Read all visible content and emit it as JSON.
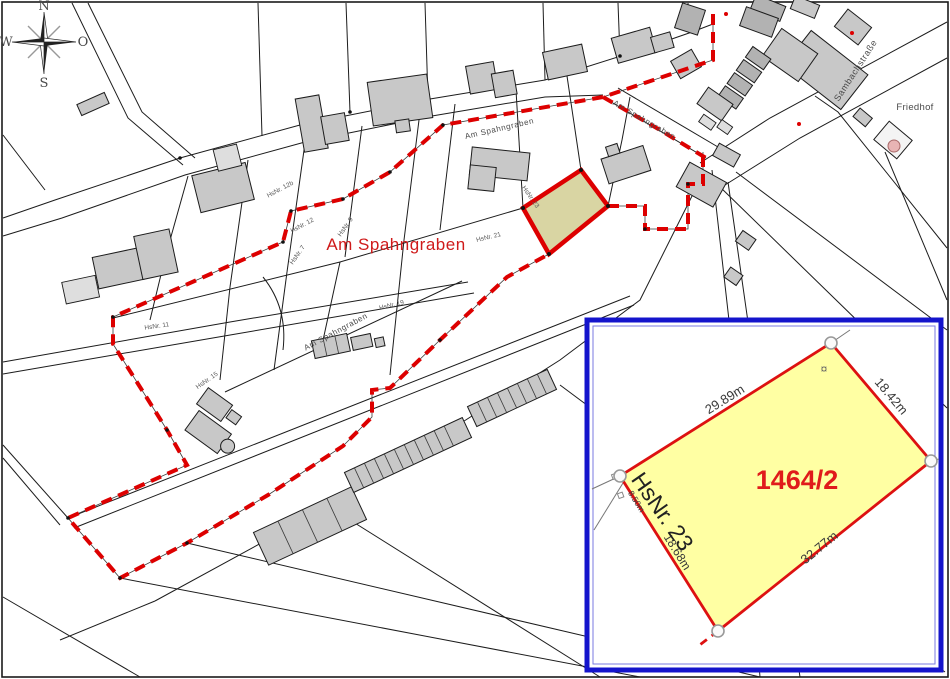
{
  "map": {
    "compass": {
      "north": "N",
      "east": "O",
      "south": "S",
      "west": "W"
    },
    "area_label_red": "Am Spahngraben",
    "street_labels": {
      "spahngraben_top": "Am Spahngraben",
      "spahngraben_branch": "Am Spahngraben",
      "spahngraben_lower": "Am Spahngraben",
      "sambachstrasse": "Sambachstraße",
      "friedhof": "Friedhof"
    },
    "house_numbers": {
      "hn_12b": "HsNr. 12b",
      "hn_12": "HsNr. 12",
      "hn_7": "HsNr. 7",
      "hn_9": "HsNr. 9",
      "hn_19": "HsNr. 19",
      "hn_21": "HsNr. 21",
      "hn_11": "HsNr. 11",
      "hn_15": "HsNr. 15"
    },
    "highlighted_parcel": {
      "house_number": "HsNr. 23"
    }
  },
  "inset": {
    "parcel_number": "1464/2",
    "house_number": "HsNr. 23",
    "lamp_symbol": "¤",
    "measurements": {
      "top_edge": "29.89m",
      "right_edge": "18.42m",
      "bottom_edge": "32.77m",
      "left_edge": "18.68m",
      "offset_small": "8.50m"
    }
  },
  "colors": {
    "boundary_red": "#dd0000",
    "highlight_parcel_fill": "#d9d5a3",
    "inset_parcel_fill": "#ffffa3",
    "inset_border_blue": "#1414cc",
    "building_fill": "#c8c8c8",
    "chapel_pink": "#e8b4b4"
  }
}
